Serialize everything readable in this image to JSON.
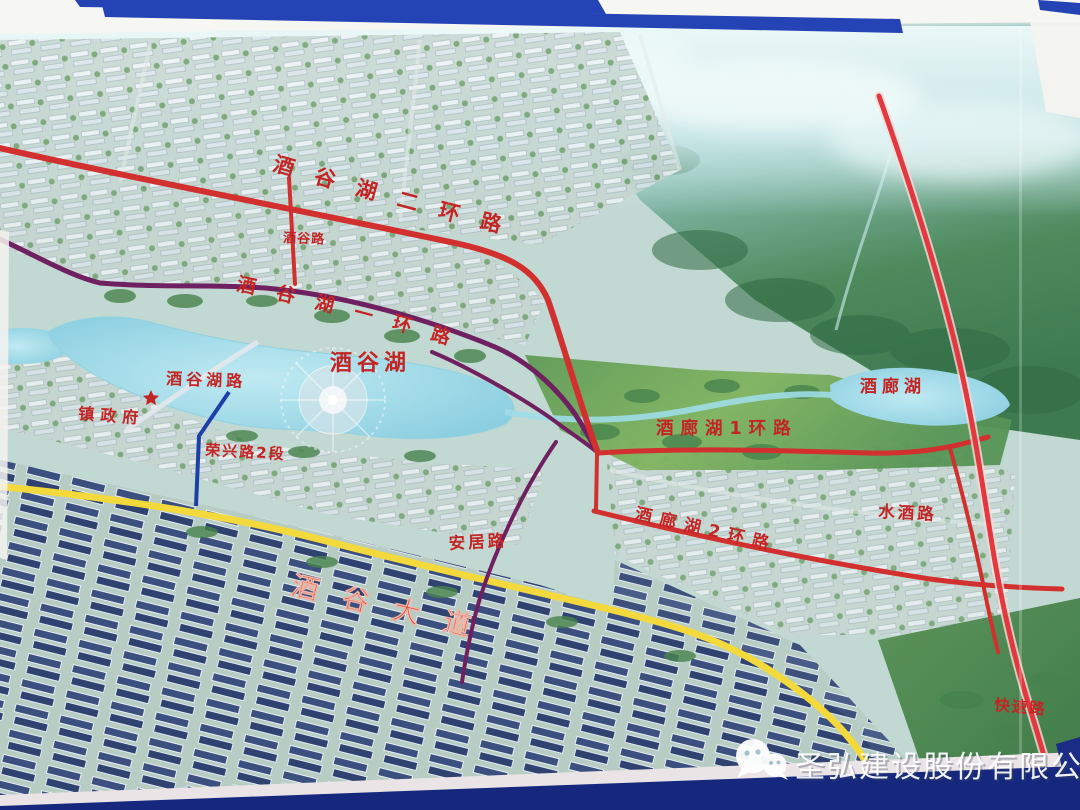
{
  "map": {
    "lakes": {
      "jiugu_lake": "酒谷湖",
      "jiulang_lake": "酒廊湖"
    },
    "roads": {
      "ring2": "酒谷湖二环路",
      "ring1": "酒谷湖一环路",
      "jiugu_road": "酒谷路",
      "jiugu_lake_road": "酒谷湖路",
      "rongxing": "荣兴路2段",
      "jiulang_ring1": "酒廊湖1环路",
      "jiulang_ring2": "酒廊湖2环路",
      "shuijiu": "水酒路",
      "anju": "安居路",
      "avenue": "酒谷大道",
      "expressway": "快速路"
    },
    "places": {
      "government": "镇政府"
    },
    "colors": {
      "label_red": "#c32424",
      "road_red": "#d22f2f",
      "road_purple": "#6f2060",
      "road_yellow": "#f3d93b",
      "road_blue": "#1c3fa8",
      "expressway_red": "#e2383f",
      "water": "#8fd2e2",
      "banner_blue": "#2443b4",
      "frame_navy": "#16287e"
    }
  },
  "watermark": {
    "icon": "wechat-icon",
    "company": "圣弘建设股份有限公司"
  }
}
